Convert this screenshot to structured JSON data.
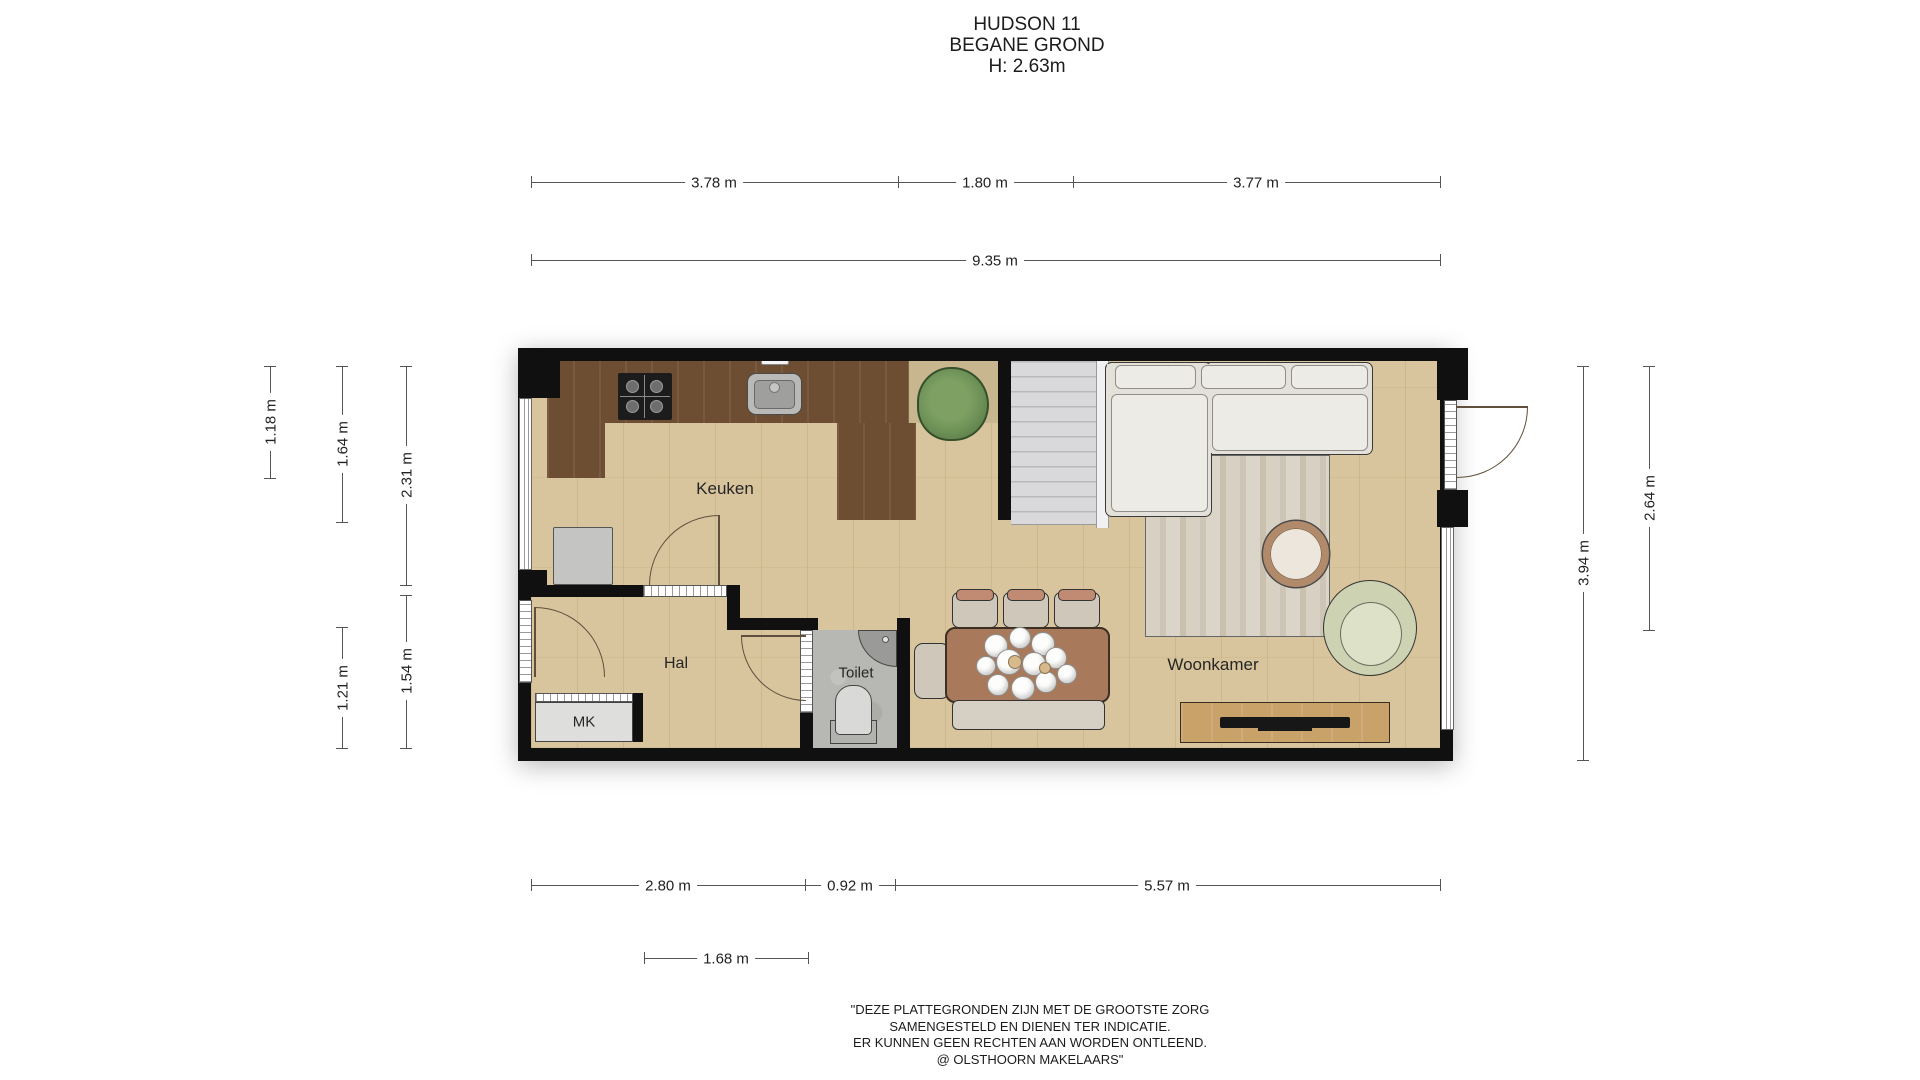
{
  "title": {
    "line1": "HUDSON 11",
    "line2": "BEGANE GROND",
    "line3": "H: 2.63m"
  },
  "rooms": {
    "keuken": "Keuken",
    "hal": "Hal",
    "toilet": "Toilet",
    "mk": "MK",
    "woonkamer": "Woonkamer"
  },
  "dimensions": {
    "top_segments": [
      {
        "label": "3.78 m"
      },
      {
        "label": "1.80 m"
      },
      {
        "label": "3.77 m"
      }
    ],
    "top_total": {
      "label": "9.35 m"
    },
    "left": [
      {
        "label": "1.18 m"
      },
      {
        "label": "1.64 m"
      },
      {
        "label": "2.31 m"
      },
      {
        "label": "1.21 m"
      },
      {
        "label": "1.54 m"
      }
    ],
    "right": [
      {
        "label": "3.94 m"
      },
      {
        "label": "2.64 m"
      }
    ],
    "bottom": [
      {
        "label": "2.80 m"
      },
      {
        "label": "0.92 m"
      },
      {
        "label": "5.57 m"
      },
      {
        "label": "1.68 m"
      }
    ]
  },
  "disclaimer": {
    "line1": "\"DEZE PLATTEGRONDEN ZIJN MET DE GROOTSTE ZORG",
    "line2": "SAMENGESTELD EN DIENEN TER INDICATIE.",
    "line3": "ER KUNNEN GEEN RECHTEN AAN WORDEN ONTLEEND.",
    "line4": "@ OLSTHOORN MAKELAARS\""
  },
  "colors": {
    "wall": "#101010",
    "floor": "#d8c59d",
    "counter": "#6e4e33",
    "counter_light": "#c8b68e",
    "toilet_floor": "#b7b7b3",
    "stairs": "#d9d9db",
    "rug": "#d5cec1",
    "couch": "#e4e1da",
    "sofa_cushion": "#edebe5",
    "wood": "#c9a269",
    "table": "#a8795b",
    "bench": "#d6cfc3",
    "chair_seat": "#cfc7ba",
    "chair_back": "#c18a72",
    "plant": "#6d9057",
    "sage": "#ccd2b2",
    "cabinet": "#c4c4c2",
    "dim": "#555555"
  }
}
